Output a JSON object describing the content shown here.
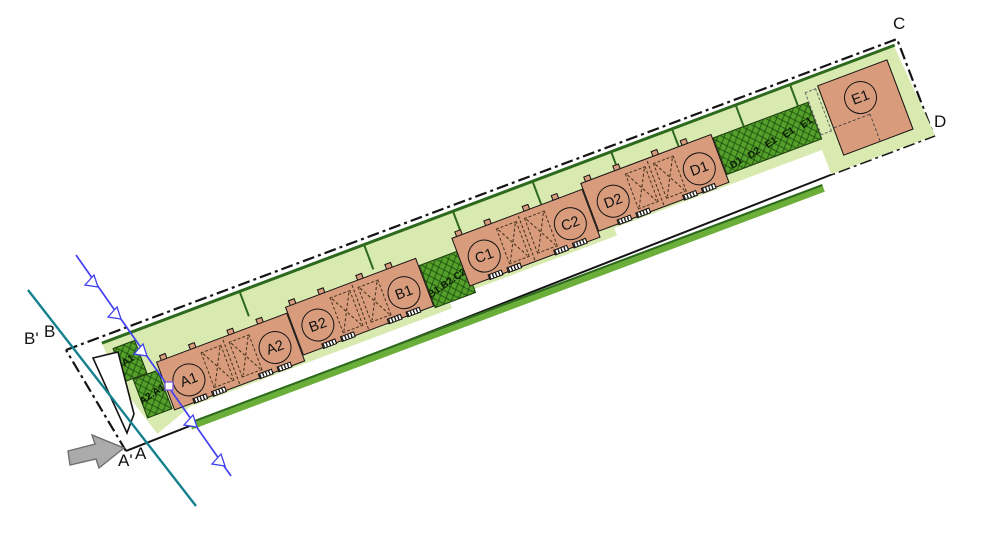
{
  "plan": {
    "corner_labels": {
      "c": "C",
      "d": "D",
      "b_prime": "B'",
      "b": "B",
      "a_prime": "A'",
      "a": "A"
    },
    "blocks": [
      {
        "id": "A",
        "x": 44,
        "front": 94,
        "units": [
          "A1",
          "A2"
        ]
      },
      {
        "id": "B",
        "x": 184,
        "front": 88,
        "units": [
          "B2",
          "B1"
        ]
      },
      {
        "id": "C",
        "x": 364,
        "front": 82,
        "units": [
          "C1",
          "C2"
        ]
      },
      {
        "id": "D",
        "x": 504,
        "front": 76,
        "units": [
          "D2",
          "D1"
        ]
      }
    ],
    "block_width": 140,
    "block_depth": 52,
    "e1": {
      "label": "E1",
      "x": 760,
      "y": 16,
      "size": 75
    },
    "parking": [
      {
        "id": "a-upper",
        "x": 8,
        "y": 14,
        "w": 24,
        "h": 36,
        "labels": [
          {
            "text": "A1",
            "x": 3,
            "y": 11
          }
        ]
      },
      {
        "id": "a-lower",
        "x": 16,
        "y": 50,
        "w": 27,
        "h": 42,
        "labels": [
          {
            "text": "A2.A1",
            "x": -2,
            "y": 15
          }
        ]
      },
      {
        "id": "b-c",
        "x": 324,
        "y": 44,
        "w": 44,
        "h": 46,
        "labels": [
          {
            "text": "B1.B2.C2.C1",
            "x": -3,
            "y": 19
          }
        ]
      },
      {
        "id": "d-e",
        "x": 644,
        "y": 28,
        "w": 102,
        "h": 40,
        "labels": [
          {
            "text": "D1",
            "x": 6,
            "y": 26
          },
          {
            "text": "D2",
            "x": 26,
            "y": 23
          },
          {
            "text": "E1",
            "x": 46,
            "y": 19
          },
          {
            "text": "E1",
            "x": 66,
            "y": 16
          },
          {
            "text": "E1",
            "x": 86,
            "y": 13
          }
        ]
      }
    ],
    "garden_dividers": [
      {
        "x": 146,
        "y": 6,
        "h": 26
      },
      {
        "x": 279,
        "y": 6,
        "h": 26
      },
      {
        "x": 374,
        "y": 6,
        "h": 38
      },
      {
        "x": 459,
        "y": 6,
        "h": 26
      },
      {
        "x": 543,
        "y": 6,
        "h": 24
      },
      {
        "x": 608,
        "y": 6,
        "h": 22
      },
      {
        "x": 676,
        "y": 6,
        "h": 22
      },
      {
        "x": 734,
        "y": 6,
        "h": 22
      }
    ],
    "colors": {
      "site_green": "#d9eab0",
      "edge_green": "#2d6a1e",
      "hatch_green": "#55a02a",
      "hedge_green": "#6cae3a",
      "building_salmon": "#d89c7c",
      "boundary_black": "#141414",
      "section_teal": "#15818e",
      "section_blue": "#4040f0",
      "marker_purple": "#7a5ae0",
      "arrow_gray": "#ababab"
    }
  }
}
